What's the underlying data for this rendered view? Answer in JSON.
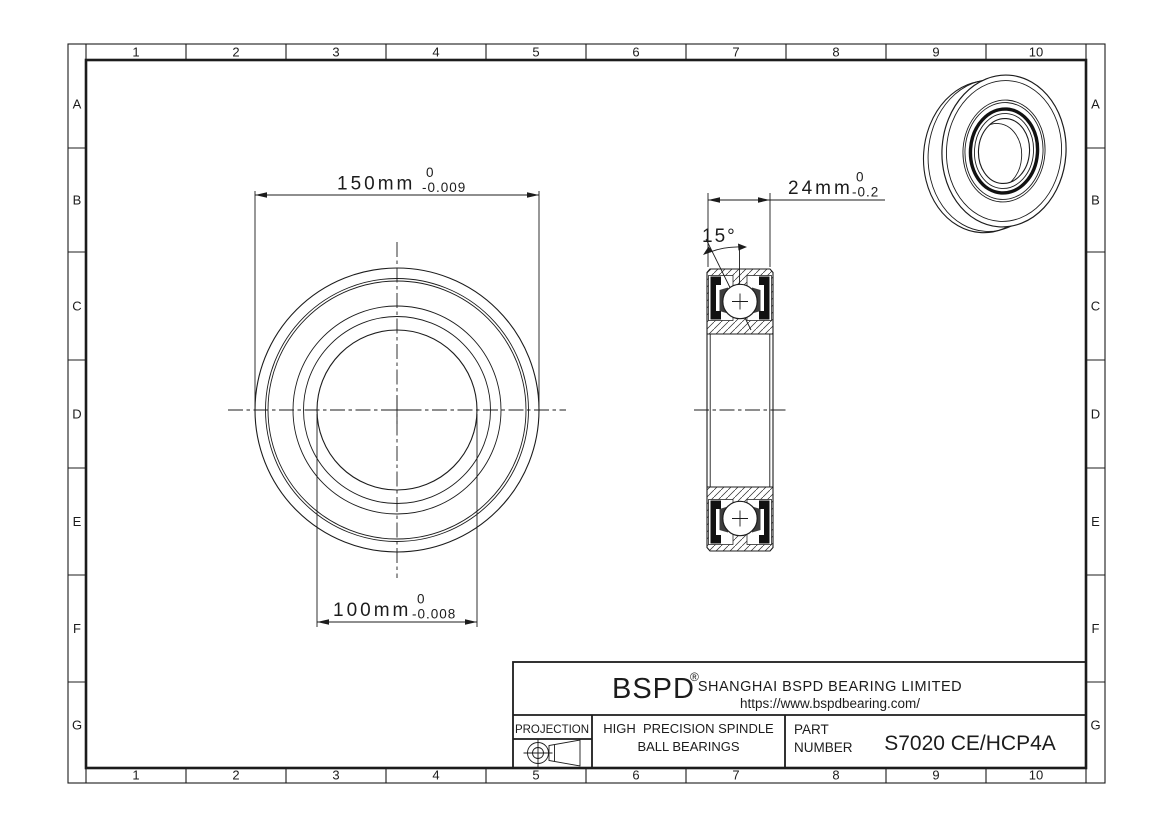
{
  "colors": {
    "ink": "#1c1c1c",
    "paper": "#ffffff",
    "seal": "#111111",
    "cage": "#3d3d3d"
  },
  "grid": {
    "cols": [
      "1",
      "2",
      "3",
      "4",
      "5",
      "6",
      "7",
      "8",
      "9",
      "10"
    ],
    "rows": [
      "A",
      "B",
      "C",
      "D",
      "E",
      "F",
      "G"
    ]
  },
  "dimensions": {
    "outer_diameter": {
      "value": "150mm",
      "tol_upper": "0",
      "tol_lower": "-0.009"
    },
    "bore_diameter": {
      "value": "100mm",
      "tol_upper": "0",
      "tol_lower": "-0.008"
    },
    "width": {
      "value": "24mm",
      "tol_upper": "0",
      "tol_lower": "-0.2"
    },
    "contact_angle": {
      "value": "15°"
    }
  },
  "title_block": {
    "brand": "BSPD",
    "registered": "®",
    "company": "SHANGHAI BSPD BEARING LIMITED",
    "website": "https://www.bspdbearing.com/",
    "projection_label": "PROJECTION",
    "product_line1": "HIGH  PRECISION SPINDLE",
    "product_line2": "BALL BEARINGS",
    "part_label_line1": "PART",
    "part_label_line2": "NUMBER",
    "part_number": "S7020 CE/HCP4A"
  }
}
